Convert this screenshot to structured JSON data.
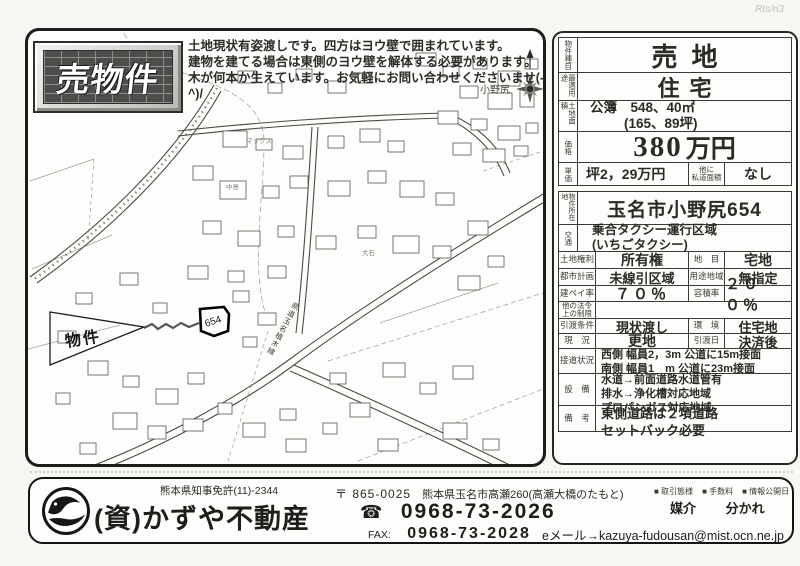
{
  "page": {
    "handwritten_note": "Rts/n3"
  },
  "banner": {
    "label": "売物件"
  },
  "notice": {
    "line1": "土地現状有姿渡しです。四方はヨウ壁で囲まれています。",
    "line2": "建物を建てる場合は東側のヨウ壁を解体する必要があります。",
    "line3": "木が何本か生えています。お気軽にお問い合わせくださいませ(-^)/"
  },
  "map": {
    "property_label": "物件",
    "parcel_number": "654",
    "compass_label": "N",
    "road_name": "県道玉名植木線",
    "places": {
      "onojiri": "小野尻",
      "nakashima": "中島",
      "oishi": "大石",
      "makkusu": "マックス"
    }
  },
  "details": {
    "type_label": "物件種目",
    "type_value": "売地",
    "use_label": "最適用途",
    "use_value": "住宅",
    "area_label": "土地面積",
    "area_line1": "公簿　548、40㎡",
    "area_line2": "(165、89坪)",
    "price_label": "価格",
    "price_number": "380",
    "price_unit": "万円",
    "unit_label": "単価",
    "unit_value": "坪2，29万円",
    "private_road_label1": "他に",
    "private_road_label2": "私道面積",
    "private_road_value": "なし",
    "location_label": "物件所在地",
    "location_value": "玉名市小野尻654",
    "transport_label": "交通",
    "transport_line1": "乗合タクシー運行区域",
    "transport_line2": "(いちごタクシー)",
    "right_label": "土地権利",
    "right_value": "所有権",
    "chimoku_label": "地　目",
    "chimoku_value": "宅地",
    "cityplan_label": "都市計画",
    "cityplan_value": "未線引区域",
    "youto_label": "用途地域",
    "youto_value": "無指定",
    "kenpei_label": "建ペイ率",
    "kenpei_value": "７０％",
    "yoseki_label": "容積率",
    "yoseki_value": "２００％",
    "otherlaw_label1": "他の法令",
    "otherlaw_label2": "上の制限",
    "otherlaw_value": "",
    "handover_label": "引渡条件",
    "handover_value": "現状渡し",
    "env_label": "環　境",
    "env_value": "住宅地",
    "status_label": "現　況",
    "status_value": "更地",
    "hdate_label": "引渡日",
    "hdate_value": "決済後",
    "roadcontact_label": "接道状況",
    "roadcontact_line1": "西側 幅員2，3m 公道に15m接面",
    "roadcontact_line2": "南側 幅員1　m 公道に23m接面",
    "setsubi_label": "設　備",
    "setsubi_line1": "水道→前面道路水道管有",
    "setsubi_line2": "排水→浄化槽対応地域",
    "setsubi_line3": "プロパンガス対応地域",
    "biko_label": "備　考",
    "biko_line1": "東側道路は２項道路",
    "biko_line2": "セットバック必要"
  },
  "footer": {
    "license": "熊本県知事免許(11)-2344",
    "company": "(資)かずや不動産",
    "postal_mark_code": "〒 865-0025",
    "address": "熊本県玉名市高瀬260(高瀬大橋のたもと)",
    "phone_icon": "☎",
    "phone": "0968-73-2026",
    "fax_label": "FAX:",
    "fax": "0968-73-2028",
    "deal_type_label": "■ 取引態様",
    "fee_label": "■ 手数料",
    "info_date_label": "■ 情報公開日",
    "deal_type_value": "媒介",
    "fee_value": "分かれ",
    "email": "eメール→kazuya-fudousan@mist.ocn.ne.jp"
  }
}
